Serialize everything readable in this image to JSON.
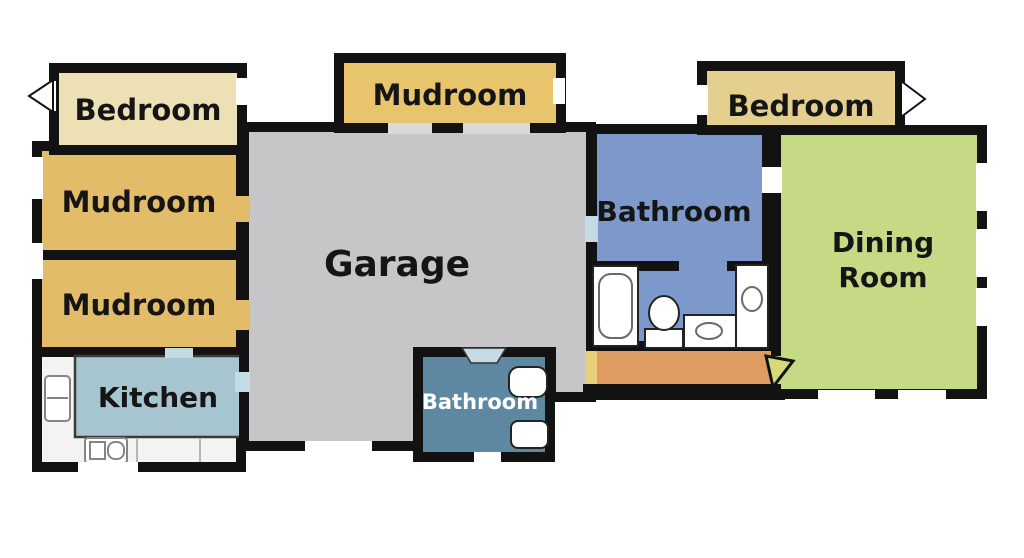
{
  "plan_title": "House floor plan",
  "palette": {
    "wall": "#121212",
    "exterior": "#ffffff",
    "bedroom_left": "#ece0b4",
    "mudroom": "#e2bc68",
    "mudroom_top": "#e8c46d",
    "garage": "#c6c6c8",
    "kitchen": "#a7c5d1",
    "counter": "#f3f3f1",
    "bathroom_small": "#5e88a2",
    "bathroom_main": "#7d98ca",
    "bedroom_right": "#e5cf8e",
    "dining": "#c6da85",
    "hallway": "#de9b62",
    "hallway_door": "#e9cf78",
    "door_blue": "#c5dbe4",
    "door_gray": "#d9d9d9",
    "door_wedge": "#d6da7a",
    "window": "#ffffff",
    "fixture": "#ffffff",
    "label_dark": "#151515",
    "label_light": "#ffffff"
  },
  "rooms": {
    "bedroom_left": {
      "label": "Bedroom"
    },
    "mudroom_1": {
      "label": "Mudroom"
    },
    "mudroom_2": {
      "label": "Mudroom"
    },
    "kitchen": {
      "label": "Kitchen"
    },
    "mudroom_top": {
      "label": "Mudroom"
    },
    "garage": {
      "label": "Garage"
    },
    "bathroom_small": {
      "label": "Bathroom"
    },
    "bathroom_main": {
      "label": "Bathroom"
    },
    "bedroom_right": {
      "label": "Bedroom"
    },
    "dining": {
      "label": "Dining Room",
      "line1": "Dining",
      "line2": "Room"
    }
  }
}
